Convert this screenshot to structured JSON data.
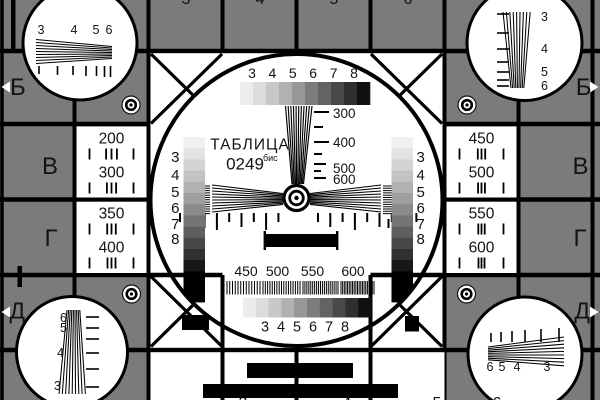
{
  "card": {
    "title": "ТАБЛИЦА",
    "number": "0249",
    "suffix": "бис"
  },
  "colors": {
    "bg_gray": "#7b7b7b",
    "ink": "#000000",
    "white": "#ffffff",
    "letter_ink": "#1b1b1b",
    "grayscale_steps": [
      "#ececec",
      "#dcdcdc",
      "#c8c8c8",
      "#b1b1b1",
      "#979797",
      "#7d7d7d",
      "#636363",
      "#494949",
      "#2f2f2f",
      "#111111"
    ],
    "strip_steps": [
      "#f0f0f0",
      "#e3e3e3",
      "#d4d4d4",
      "#c3c3c3",
      "#b1b1b1",
      "#9e9e9e",
      "#8a8a8a",
      "#757575",
      "#5f5f5f",
      "#484848",
      "#303030",
      "#181818"
    ]
  },
  "center": {
    "top_scale_labels": [
      "3",
      "4",
      "5",
      "6",
      "7",
      "8"
    ],
    "bottom_scale_labels": [
      "3",
      "4",
      "5",
      "6",
      "7",
      "8"
    ],
    "wedge_tick_labels": [
      "300",
      "400",
      "500",
      "600"
    ],
    "frequency_labels": [
      "450",
      "500",
      "550",
      "600"
    ],
    "left_strip_labels": [
      "3",
      "4",
      "5",
      "6",
      "7",
      "8"
    ],
    "right_strip_labels": [
      "3",
      "4",
      "5",
      "6",
      "7",
      "8"
    ]
  },
  "side_cells": {
    "left": [
      "200",
      "300",
      "350",
      "400"
    ],
    "right": [
      "450",
      "500",
      "550",
      "600"
    ]
  },
  "corner_circles": {
    "top_left_labels": [
      "3",
      "4",
      "5",
      "6"
    ],
    "top_right_labels": [
      "3",
      "4",
      "5",
      "6"
    ],
    "bottom_left_labels": [
      "6",
      "5",
      "4",
      "3"
    ],
    "bottom_right_labels": [
      "6",
      "5",
      "4",
      "3"
    ]
  },
  "edge_markers": {
    "left": [
      "Б",
      "В",
      "Г",
      "Д"
    ],
    "right": [
      "Б",
      "В",
      "Г",
      "Д"
    ]
  },
  "edge_digits": {
    "top": [
      "3",
      "4",
      "5",
      "6"
    ],
    "bottom": [
      "3",
      "4",
      "5",
      "6"
    ]
  }
}
